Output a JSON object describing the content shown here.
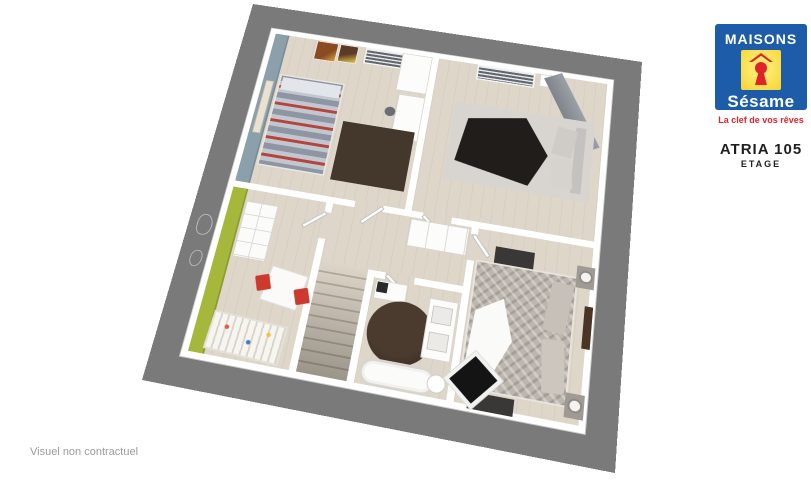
{
  "branding": {
    "logo_top": "MAISONS",
    "logo_name": "Sésame",
    "tagline": "La clef de vos rêves"
  },
  "plan": {
    "model": "ATRIA 105",
    "level": "ETAGE"
  },
  "footer": {
    "disclaimer": "Visuel non contractuel"
  },
  "colors": {
    "brand_blue": "#1d5ca9",
    "brand_yellow": "#f8d32f",
    "brand_red": "#e2222a",
    "text_dark": "#1f1f1f",
    "muted_gray": "#9b9b9b",
    "frame_gray": "#7a7a7a",
    "floor_beige": "#ddd6c9",
    "wall_white": "#ffffff",
    "accent_green": "#a5b83c",
    "accent_bluegray": "#8ba0ab",
    "rug_brown": "#44372c",
    "rug_charcoal": "#3a3836",
    "chair_red": "#cc3a2f",
    "stairs_dark": "#6e665a"
  }
}
